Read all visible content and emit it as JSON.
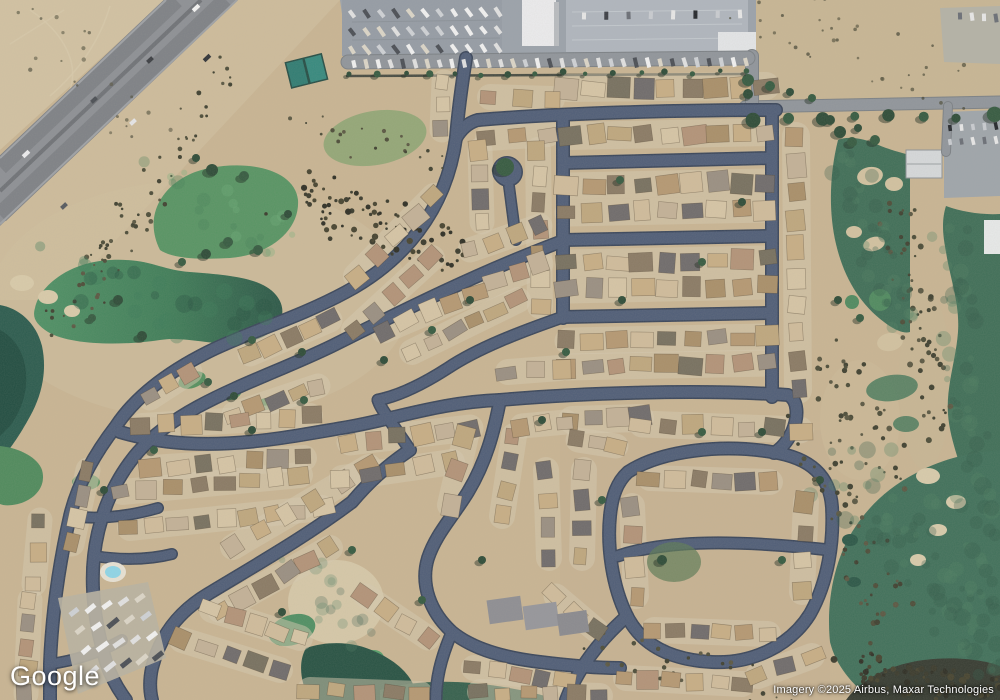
{
  "branding": {
    "logo_text": "Google"
  },
  "attribution": {
    "text": "Imagery ©2025 Airbus, Maxar Technologies"
  },
  "palette": {
    "desert": "#c9b593",
    "desert_light": "#d6c6a8",
    "desert_dark": "#b3a183",
    "street": "#4f5d77",
    "street_dark": "#39455a",
    "road": "#90959b",
    "road_dark": "#7b8085",
    "highway": "#8d9095",
    "highway_lane": "#7e8186",
    "highway_median": "#6f7277",
    "parking": "#9ba2ab",
    "parking_light": "#b0b6be",
    "parking_dark": "#959ca5",
    "golf_bright": "#579463",
    "golf_dark": "#3f6e57",
    "water": "#3f7d58",
    "water_dark": "#2b5747",
    "pool": "#8fd6e8",
    "lot": "#d5c9b0",
    "tree": "#2d4b37",
    "tree2": "#355a40",
    "tree_shadow": "#1c2a20"
  },
  "map": {
    "roof_colors": [
      "#c8ae85",
      "#b59872",
      "#d0bc9b",
      "#9a8f82",
      "#8a7a64",
      "#c3b197",
      "#77705f",
      "#b39378",
      "#d6c5a5",
      "#6f6b6b",
      "#bfa77e",
      "#a98f69"
    ],
    "vehicle_colors": {
      "rv": [
        "#f2f2f2",
        "#e2e2e2",
        "#cfd2d6",
        "#4a4e55",
        "#dcd6c8"
      ],
      "car": [
        "#3a3d44",
        "#e8e8e8",
        "#6a6e76",
        "#23262b",
        "#c9ccd1"
      ]
    },
    "bush_colors": {
      "dark": [
        "#3a3a2c",
        "#2e2e24",
        "#46432f"
      ],
      "olive": [
        "#4c4c38",
        "#5a5742",
        "#3f4030"
      ],
      "gmot": [
        "#4e8062",
        "#33594a"
      ],
      "gmot2": [
        "#6fae7c",
        "#477f55"
      ],
      "wmot": [
        "#3c7a58",
        "#24513f"
      ]
    },
    "streets": [
      {
        "d": "M478,120 C560,113 680,110 776,110",
        "w": 11
      },
      {
        "d": "M563,163 L770,158",
        "w": 11
      },
      {
        "d": "M563,240 L770,236",
        "w": 11
      },
      {
        "d": "M562,317 L770,313",
        "w": 11
      },
      {
        "d": "M500,400 C580,393 700,389 788,395 C798,400 799,416 792,432 C786,444 779,450 774,453",
        "w": 11
      },
      {
        "d": "M772,110 L772,397",
        "w": 11
      },
      {
        "d": "M563,118 L563,318",
        "w": 11
      },
      {
        "d": "M456,138 C462,128 470,122 478,120",
        "w": 11
      },
      {
        "d": "M466,58 C461,90 458,112 456,138",
        "w": 11
      },
      {
        "d": "M456,138 C446,212 402,262 346,292 C298,318 248,332 208,352 C168,372 136,396 116,426 C96,452 78,482 70,516 C60,560 52,612 50,664 L50,700",
        "w": 11
      },
      {
        "d": "M560,242 C480,272 404,310 332,346 C262,380 182,402 138,452 C112,482 98,520 94,556 C90,592 96,628 106,662 C112,680 120,692 126,700",
        "w": 11
      },
      {
        "d": "M509,186 C512,210 514,224 516,240",
        "w": 9
      },
      {
        "d": "M507,171 L508,172",
        "w": 27
      },
      {
        "d": "M120,432 C200,456 282,438 342,428 C392,420 440,402 500,400",
        "w": 11
      },
      {
        "d": "M410,450 C392,462 372,478 352,502 C304,538 254,566 208,594 C178,612 160,636 152,668 C149,682 150,692 152,700",
        "w": 11
      },
      {
        "d": "M500,400 C494,432 486,462 468,492 C452,518 436,534 428,558 C420,584 430,612 452,632 C474,650 506,658 540,662 C572,666 600,668 620,668",
        "w": 11
      },
      {
        "d": "M628,472 C662,450 722,444 772,452 C812,458 830,477 832,507 C834,542 828,582 810,614 C790,646 752,664 712,662 C672,660 642,646 627,616 C612,586 607,546 610,516 C612,496 617,482 628,472 Z",
        "w": 11
      },
      {
        "d": "M618,556 C660,542 720,538 830,550",
        "w": 10
      },
      {
        "d": "M563,317 C520,332 478,348 448,368 C420,386 398,396 378,400",
        "w": 10
      },
      {
        "d": "M410,450 C390,420 380,408 378,400",
        "w": 10
      },
      {
        "d": "M627,616 C600,640 578,668 566,700",
        "w": 11
      },
      {
        "d": "M452,632 C440,660 436,680 436,700",
        "w": 10
      },
      {
        "d": "M70,516 C100,520 130,516 158,508",
        "w": 9
      },
      {
        "d": "M50,664 C80,660 104,650 122,640",
        "w": 9
      },
      {
        "d": "M94,556 C120,560 148,560 172,554",
        "w": 9
      }
    ],
    "roads": [
      {
        "d": "M745,107 L1000,102",
        "w": 11
      },
      {
        "d": "M752,56 L752,108",
        "w": 12
      },
      {
        "d": "M348,62 L748,58",
        "w": 13
      },
      {
        "d": "M948,106 L946,152",
        "w": 8
      }
    ],
    "house_rows": [
      [
        568,
        88,
        766,
        86,
        9,
        19
      ],
      [
        490,
        97,
        552,
        99,
        3,
        17
      ],
      [
        488,
        138,
        548,
        134,
        3,
        17
      ],
      [
        572,
        136,
        766,
        132,
        9,
        19
      ],
      [
        568,
        186,
        766,
        182,
        9,
        18
      ],
      [
        568,
        213,
        766,
        209,
        9,
        18
      ],
      [
        568,
        263,
        766,
        259,
        9,
        18
      ],
      [
        568,
        290,
        766,
        286,
        9,
        18
      ],
      [
        568,
        341,
        766,
        337,
        9,
        18
      ],
      [
        568,
        367,
        766,
        363,
        9,
        18
      ],
      [
        508,
        372,
        560,
        368,
        3,
        17
      ],
      [
        572,
        420,
        640,
        418,
        4,
        19
      ],
      [
        796,
        136,
        798,
        390,
        10,
        19
      ],
      [
        538,
        150,
        540,
        306,
        7,
        17
      ],
      [
        480,
        150,
        482,
        222,
        4,
        16
      ],
      [
        444,
        82,
        442,
        130,
        3,
        16
      ],
      [
        434,
        196,
        356,
        276,
        5,
        17
      ],
      [
        432,
        258,
        354,
        330,
        5,
        17
      ],
      [
        540,
        226,
        470,
        250,
        4,
        16
      ],
      [
        540,
        264,
        384,
        330,
        8,
        18
      ],
      [
        518,
        300,
        412,
        352,
        6,
        17
      ],
      [
        330,
        320,
        250,
        354,
        5,
        16
      ],
      [
        318,
        386,
        234,
        414,
        5,
        16
      ],
      [
        190,
        372,
        150,
        398,
        3,
        16
      ],
      [
        88,
        470,
        72,
        544,
        4,
        16
      ],
      [
        40,
        520,
        34,
        584,
        3,
        16
      ],
      [
        30,
        600,
        26,
        694,
        5,
        16
      ],
      [
        142,
        426,
        310,
        416,
        8,
        17
      ],
      [
        152,
        468,
        304,
        458,
        7,
        17
      ],
      [
        122,
        492,
        300,
        475,
        8,
        17
      ],
      [
        130,
        528,
        322,
        508,
        9,
        17
      ],
      [
        369,
        467,
        233,
        547,
        6,
        17
      ],
      [
        330,
        548,
        220,
        610,
        6,
        17
      ],
      [
        182,
        640,
        280,
        670,
        5,
        17
      ],
      [
        212,
        610,
        300,
        638,
        5,
        17
      ],
      [
        310,
        690,
        420,
        694,
        5,
        17
      ],
      [
        350,
        442,
        470,
        428,
        6,
        18
      ],
      [
        342,
        478,
        452,
        462,
        5,
        17
      ],
      [
        466,
        436,
        450,
        505,
        3,
        17
      ],
      [
        514,
        436,
        502,
        516,
        4,
        17
      ],
      [
        546,
        470,
        549,
        558,
        4,
        17
      ],
      [
        584,
        470,
        582,
        558,
        4,
        17
      ],
      [
        366,
        596,
        428,
        638,
        4,
        16
      ],
      [
        474,
        668,
        564,
        680,
        5,
        17
      ],
      [
        480,
        692,
        600,
        696,
        6,
        17
      ],
      [
        556,
        596,
        596,
        630,
        3,
        16
      ],
      [
        578,
        440,
        616,
        446,
        3,
        16
      ],
      [
        522,
        426,
        566,
        422,
        3,
        16
      ],
      [
        642,
        424,
        800,
        430,
        7,
        18
      ],
      [
        650,
        478,
        770,
        482,
        6,
        17
      ],
      [
        654,
        630,
        768,
        634,
        6,
        17
      ],
      [
        632,
        506,
        636,
        596,
        4,
        17
      ],
      [
        806,
        502,
        802,
        592,
        4,
        17
      ],
      [
        626,
        678,
        742,
        684,
        6,
        17
      ],
      [
        758,
        676,
        812,
        656,
        3,
        17
      ]
    ],
    "bush_fields": [
      [
        292,
        192,
        448,
        256,
        90,
        26,
        1.2,
        3.2,
        "dark",
        1
      ],
      [
        898,
        206,
        940,
        424,
        60,
        18,
        1.2,
        3,
        "olive",
        1
      ],
      [
        822,
        356,
        893,
        468,
        40,
        24,
        1.2,
        3,
        "olive",
        1
      ],
      [
        814,
        434,
        896,
        634,
        50,
        26,
        1.2,
        3,
        "olive",
        1
      ],
      [
        850,
        668,
        998,
        692,
        80,
        16,
        1.5,
        3.5,
        "dark",
        1
      ],
      [
        238,
        64,
        82,
        284,
        40,
        18,
        1,
        2.6,
        "olive",
        1
      ],
      [
        306,
        122,
        440,
        168,
        22,
        16,
        1,
        2.2,
        "olive",
        1
      ],
      [
        604,
        650,
        780,
        694,
        30,
        20,
        1,
        2.4,
        "olive",
        1
      ],
      [
        138,
        202,
        62,
        328,
        28,
        22,
        1,
        2.4,
        "olive",
        1
      ],
      [
        764,
        10,
        940,
        88,
        36,
        34,
        1,
        2.2,
        "olive",
        0.7
      ],
      [
        20,
        20,
        150,
        120,
        24,
        40,
        1,
        2.2,
        "olive",
        0.6
      ],
      [
        852,
        162,
        898,
        328,
        36,
        20,
        3,
        8,
        "gmot",
        0.3
      ],
      [
        950,
        224,
        992,
        686,
        70,
        18,
        3,
        9,
        "gmot",
        0.3
      ],
      [
        846,
        464,
        988,
        648,
        60,
        36,
        3,
        9,
        "gmot",
        0.3
      ],
      [
        66,
        272,
        256,
        330,
        28,
        26,
        4,
        9,
        "wmot",
        0.35
      ],
      [
        166,
        180,
        286,
        246,
        20,
        22,
        3,
        7,
        "gmot2",
        0.3
      ],
      [
        300,
        572,
        368,
        636,
        16,
        18,
        3,
        7,
        "gmot",
        0.25
      ]
    ],
    "tree_rows": [
      [
        756,
        119,
        992,
        116,
        8,
        6
      ],
      [
        352,
        75,
        744,
        72,
        16,
        3
      ]
    ],
    "trees": [
      [
        212,
        170,
        6
      ],
      [
        244,
        176,
        5
      ],
      [
        196,
        158,
        4
      ],
      [
        228,
        242,
        5
      ],
      [
        206,
        254,
        5
      ],
      [
        258,
        250,
        5
      ],
      [
        288,
        214,
        4
      ],
      [
        182,
        262,
        4
      ],
      [
        118,
        300,
        5
      ],
      [
        92,
        318,
        4
      ],
      [
        142,
        336,
        5
      ],
      [
        252,
        340,
        4
      ],
      [
        302,
        352,
        4
      ],
      [
        208,
        382,
        4
      ],
      [
        234,
        396,
        4
      ],
      [
        505,
        167,
        9
      ],
      [
        470,
        300,
        4
      ],
      [
        432,
        330,
        4
      ],
      [
        384,
        360,
        4
      ],
      [
        304,
        400,
        4
      ],
      [
        252,
        430,
        4
      ],
      [
        154,
        450,
        4
      ],
      [
        104,
        490,
        4
      ],
      [
        566,
        352,
        4
      ],
      [
        622,
        300,
        4
      ],
      [
        702,
        262,
        4
      ],
      [
        742,
        202,
        4
      ],
      [
        620,
        180,
        4
      ],
      [
        542,
        420,
        4
      ],
      [
        602,
        500,
        4
      ],
      [
        662,
        560,
        5
      ],
      [
        782,
        560,
        4
      ],
      [
        820,
        480,
        4
      ],
      [
        352,
        550,
        4
      ],
      [
        282,
        612,
        4
      ],
      [
        422,
        600,
        4
      ],
      [
        482,
        560,
        4
      ],
      [
        702,
        432,
        4
      ],
      [
        762,
        432,
        4
      ],
      [
        875,
        140,
        5
      ],
      [
        858,
        128,
        4
      ],
      [
        770,
        86,
        5
      ],
      [
        790,
        92,
        4
      ],
      [
        812,
        98,
        4
      ],
      [
        838,
        300,
        4
      ],
      [
        860,
        318,
        4
      ],
      [
        840,
        132,
        6
      ],
      [
        852,
        142,
        5
      ],
      [
        830,
        120,
        5
      ],
      [
        748,
        80,
        6
      ],
      [
        748,
        94,
        5
      ]
    ],
    "vehicle_rows": [
      [
        352,
        14,
        498,
        12,
        11,
        10,
        4,
        55,
        "rv"
      ],
      [
        352,
        32,
        498,
        30,
        11,
        10,
        4,
        55,
        "rv"
      ],
      [
        352,
        50,
        498,
        48,
        11,
        10,
        4,
        55,
        "rv"
      ],
      [
        354,
        64,
        746,
        62,
        33,
        9,
        4,
        75,
        "rv"
      ],
      [
        584,
        16,
        740,
        14,
        8,
        8,
        4,
        90,
        "car"
      ],
      [
        74,
        612,
        140,
        598,
        5,
        12,
        5,
        -38,
        "rv"
      ],
      [
        80,
        630,
        146,
        616,
        5,
        12,
        5,
        -38,
        "rv"
      ],
      [
        86,
        650,
        152,
        636,
        5,
        12,
        5,
        -38,
        "rv"
      ],
      [
        94,
        670,
        158,
        656,
        5,
        12,
        5,
        -38,
        "rv"
      ],
      [
        960,
        16,
        996,
        18,
        4,
        8,
        4,
        85,
        "car"
      ],
      [
        950,
        128,
        996,
        126,
        5,
        7,
        3.5,
        80,
        "car"
      ],
      [
        950,
        142,
        996,
        140,
        5,
        7,
        3.5,
        80,
        "car"
      ]
    ],
    "vehicles": [
      [
        196,
        8,
        -43,
        8,
        4,
        "#f4f4f4"
      ],
      [
        207,
        58,
        -43,
        8,
        4,
        "#2f3237"
      ],
      [
        94,
        100,
        -43,
        7,
        4,
        "#4a4e54"
      ],
      [
        26,
        154,
        -43,
        8,
        4,
        "#ededef"
      ],
      [
        133,
        122,
        -43,
        7,
        4,
        "#e6e6e8"
      ],
      [
        64,
        206,
        -43,
        7,
        4,
        "#55595f"
      ],
      [
        150,
        60,
        -43,
        7,
        4,
        "#3a3d42"
      ]
    ]
  }
}
